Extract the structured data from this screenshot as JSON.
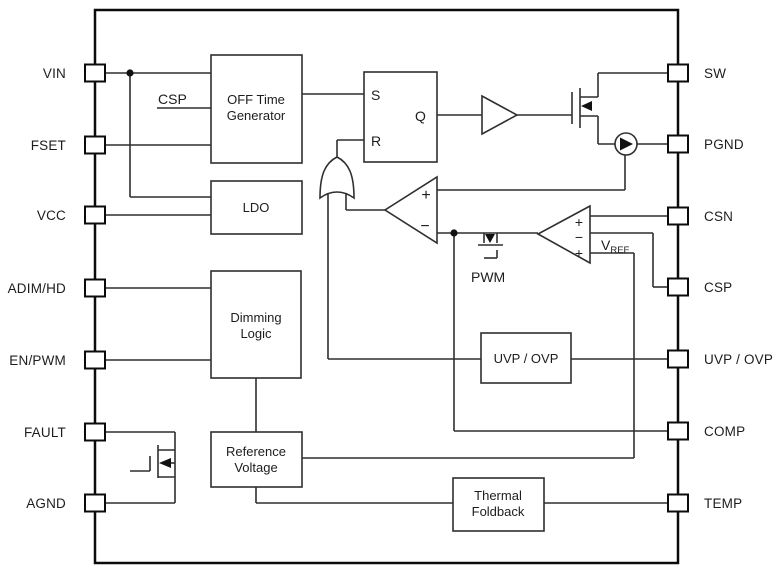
{
  "colors": {
    "background": "#ffffff",
    "wire": "#2f2f2f",
    "border": "#0b0b0b",
    "text": "#1d1d1d"
  },
  "pins": {
    "left": [
      {
        "label": "VIN"
      },
      {
        "label": "FSET"
      },
      {
        "label": "VCC"
      },
      {
        "label": "ADIM/HD"
      },
      {
        "label": "EN/PWM"
      },
      {
        "label": "FAULT"
      },
      {
        "label": "AGND"
      }
    ],
    "right": [
      {
        "label": "SW"
      },
      {
        "label": "PGND"
      },
      {
        "label": "CSN"
      },
      {
        "label": "CSP"
      },
      {
        "label": "UVP / OVP"
      },
      {
        "label": "COMP"
      },
      {
        "label": "TEMP"
      }
    ]
  },
  "blocks": {
    "off_time_generator": {
      "line1": "OFF Time",
      "line2": "Generator"
    },
    "ldo": {
      "label": "LDO"
    },
    "dimming_logic": {
      "line1": "Dimming",
      "line2": "Logic"
    },
    "reference_voltage": {
      "line1": "Reference",
      "line2": "Voltage"
    },
    "uvp_ovp": {
      "label": "UVP / OVP"
    },
    "thermal_foldback": {
      "line1": "Thermal",
      "line2": "Foldback"
    }
  },
  "latch": {
    "s": "S",
    "r": "R",
    "q": "Q"
  },
  "comparators": {
    "main": {
      "plus": "+",
      "minus": "−"
    },
    "error": {
      "plus_top": "+",
      "minus": "−",
      "plus_bottom": "+"
    }
  },
  "net_labels": {
    "csp": "CSP",
    "pwm": "PWM",
    "vref_base": "V",
    "vref_sub": "REF"
  }
}
